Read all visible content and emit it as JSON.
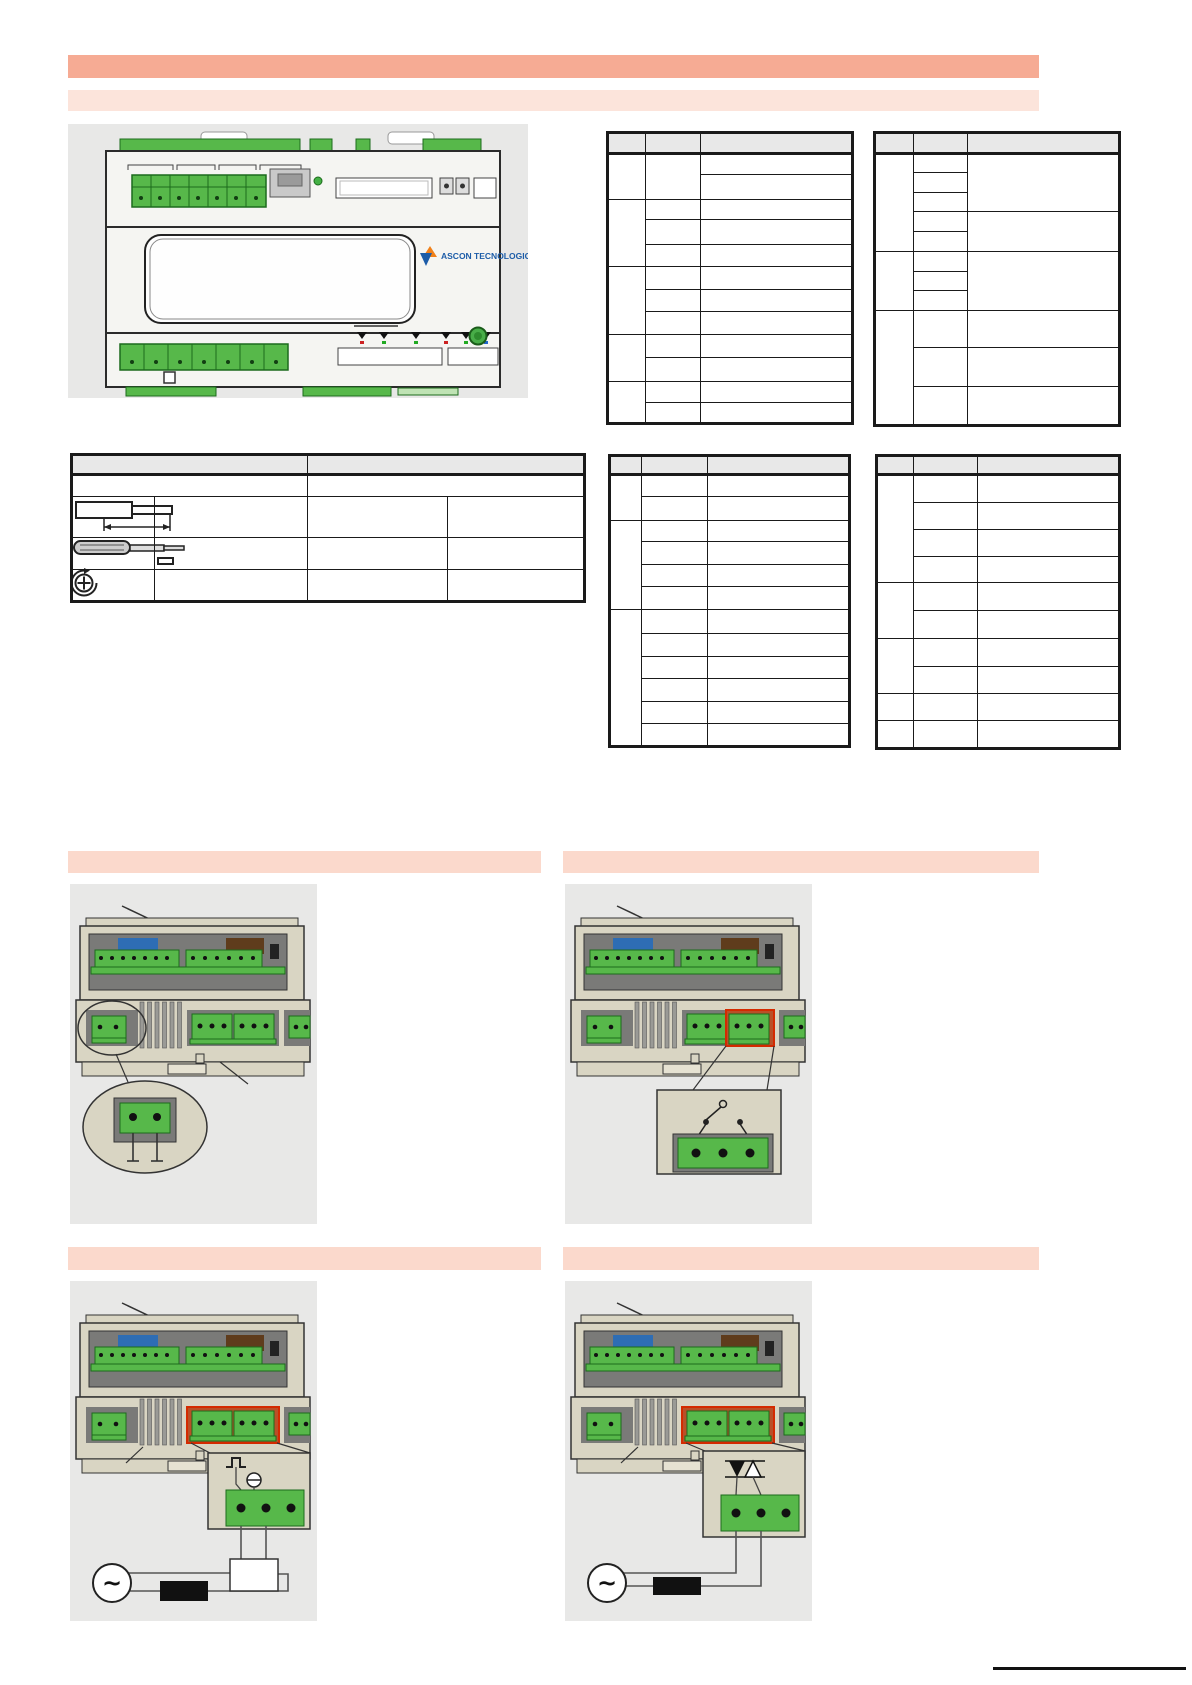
{
  "page": {
    "width": 1192,
    "height": 1685
  },
  "header": {
    "title_bar_text": "",
    "subtitle_bar_text": ""
  },
  "device_front": {
    "brand": "ASCON TECNOLOGIC"
  },
  "sections": {
    "row1_left_text": "",
    "row1_right_text": "",
    "row2_left_text": "",
    "row2_right_text": ""
  },
  "colors": {
    "banner_primary": "#f6ab94",
    "banner_secondary": "#fce4db",
    "banner_section": "#fbd9cc",
    "panel_bg": "#e8e8e7",
    "table_header_bg": "#e8e8e8",
    "table_border": "#1a1a1a",
    "terminal_green": "#57b84a",
    "terminal_green_dark": "#1c6b1c",
    "device_tan": "#d9d5c3",
    "device_tan_light": "#e6e2d2",
    "recess_gray": "#7a7a78",
    "vent_gray": "#9a9a96",
    "block_blue": "#2e6db4",
    "block_brown": "#5f3c1c",
    "highlight_red": "#b95028",
    "highlight_red_border": "#d42a00",
    "logo_blue": "#1c5ca8",
    "logo_orange": "#f08019",
    "led_red": "#cc2222",
    "led_green": "#22aa22",
    "led_blue": "#2266cc",
    "outline": "#2b2b2b"
  },
  "icons": [
    "wire-strip-length-icon",
    "screwdriver-icon",
    "torque-screw-icon"
  ],
  "tables": [
    {
      "name": "terminal-table-top-left",
      "x": 606,
      "y": 131,
      "cols": [
        38,
        55,
        152
      ],
      "rows": [
        {
          "h": 21,
          "head": true,
          "cells": [
            {},
            {},
            {}
          ]
        },
        {
          "h": 21,
          "cells": [
            {
              "rs": 2
            },
            {
              "rs": 2
            },
            {}
          ]
        },
        {
          "h": 25,
          "cells": [
            {}
          ]
        },
        {
          "h": 20,
          "cells": [
            {
              "rs": 3
            },
            {},
            {}
          ]
        },
        {
          "h": 25,
          "cells": [
            {},
            {}
          ]
        },
        {
          "h": 22,
          "cells": [
            {},
            {}
          ]
        },
        {
          "h": 23,
          "cells": [
            {
              "rs": 3
            },
            {},
            {}
          ]
        },
        {
          "h": 22,
          "cells": [
            {},
            {}
          ]
        },
        {
          "h": 23,
          "cells": [
            {},
            {}
          ]
        },
        {
          "h": 23,
          "cells": [
            {
              "rs": 2
            },
            {},
            {}
          ]
        },
        {
          "h": 24,
          "cells": [
            {},
            {}
          ]
        },
        {
          "h": 21,
          "cells": [
            {
              "rs": 2
            },
            {},
            {}
          ]
        },
        {
          "h": 21,
          "cells": [
            {},
            {}
          ]
        }
      ]
    },
    {
      "name": "terminal-table-top-right",
      "x": 873,
      "y": 131,
      "cols": [
        39,
        54,
        152
      ],
      "rows": [
        {
          "h": 21,
          "head": true,
          "cells": [
            {},
            {},
            {}
          ]
        },
        {
          "h": 19,
          "cells": [
            {
              "rs": 5
            },
            {},
            {
              "rs": 3
            }
          ]
        },
        {
          "h": 20,
          "cells": [
            {}
          ]
        },
        {
          "h": 19,
          "cells": [
            {}
          ]
        },
        {
          "h": 20,
          "cells": [
            {},
            {
              "rs": 2
            }
          ]
        },
        {
          "h": 20,
          "cells": [
            {}
          ]
        },
        {
          "h": 20,
          "cells": [
            {
              "rs": 3
            },
            {},
            {
              "rs": 3
            }
          ]
        },
        {
          "h": 19,
          "cells": [
            {}
          ]
        },
        {
          "h": 20,
          "cells": [
            {}
          ]
        },
        {
          "h": 37,
          "cells": [
            {
              "rs": 3
            },
            {},
            {}
          ]
        },
        {
          "h": 39,
          "cells": [
            {},
            {}
          ]
        },
        {
          "h": 39,
          "cells": [
            {},
            {}
          ]
        }
      ]
    },
    {
      "name": "connection-spec-table",
      "x": 70,
      "y": 453,
      "cols": [
        83,
        153,
        140,
        137
      ],
      "rows": [
        {
          "h": 20,
          "head": true,
          "cells": [
            {
              "cs": 2
            },
            {
              "cs": 2
            }
          ]
        },
        {
          "h": 22,
          "cells": [
            {
              "cs": 2
            },
            {
              "cs": 2
            }
          ]
        },
        {
          "h": 41,
          "cells": [
            {},
            {},
            {},
            {}
          ]
        },
        {
          "h": 32,
          "cells": [
            {},
            {},
            {},
            {}
          ]
        },
        {
          "h": 32,
          "cells": [
            {},
            {},
            {},
            {}
          ]
        }
      ]
    },
    {
      "name": "terminal-table-mid-left",
      "x": 608,
      "y": 454,
      "cols": [
        32,
        66,
        142
      ],
      "rows": [
        {
          "h": 19,
          "head": true,
          "cells": [
            {},
            {},
            {}
          ]
        },
        {
          "h": 22,
          "cells": [
            {
              "rs": 2
            },
            {},
            {}
          ]
        },
        {
          "h": 24,
          "cells": [
            {},
            {}
          ]
        },
        {
          "h": 21,
          "cells": [
            {
              "rs": 4
            },
            {},
            {}
          ]
        },
        {
          "h": 23,
          "cells": [
            {},
            {}
          ]
        },
        {
          "h": 22,
          "cells": [
            {},
            {}
          ]
        },
        {
          "h": 23,
          "cells": [
            {},
            {}
          ]
        },
        {
          "h": 24,
          "cells": [
            {
              "rs": 6
            },
            {},
            {}
          ]
        },
        {
          "h": 23,
          "cells": [
            {},
            {}
          ]
        },
        {
          "h": 22,
          "cells": [
            {},
            {}
          ]
        },
        {
          "h": 23,
          "cells": [
            {},
            {}
          ]
        },
        {
          "h": 22,
          "cells": [
            {},
            {}
          ]
        },
        {
          "h": 23,
          "cells": [
            {},
            {}
          ]
        }
      ]
    },
    {
      "name": "terminal-table-mid-right",
      "x": 875,
      "y": 454,
      "cols": [
        37,
        64,
        142
      ],
      "rows": [
        {
          "h": 19,
          "head": true,
          "cells": [
            {},
            {},
            {}
          ]
        },
        {
          "h": 28,
          "cells": [
            {
              "rs": 4
            },
            {},
            {}
          ]
        },
        {
          "h": 27,
          "cells": [
            {},
            {}
          ]
        },
        {
          "h": 27,
          "cells": [
            {},
            {}
          ]
        },
        {
          "h": 26,
          "cells": [
            {},
            {}
          ]
        },
        {
          "h": 28,
          "cells": [
            {
              "rs": 2
            },
            {},
            {}
          ]
        },
        {
          "h": 28,
          "cells": [
            {},
            {}
          ]
        },
        {
          "h": 28,
          "cells": [
            {
              "rs": 2
            },
            {},
            {}
          ]
        },
        {
          "h": 27,
          "cells": [
            {},
            {}
          ]
        },
        {
          "h": 27,
          "cells": [
            {},
            {},
            {}
          ]
        },
        {
          "h": 28,
          "cells": [
            {},
            {},
            {}
          ]
        }
      ]
    }
  ]
}
